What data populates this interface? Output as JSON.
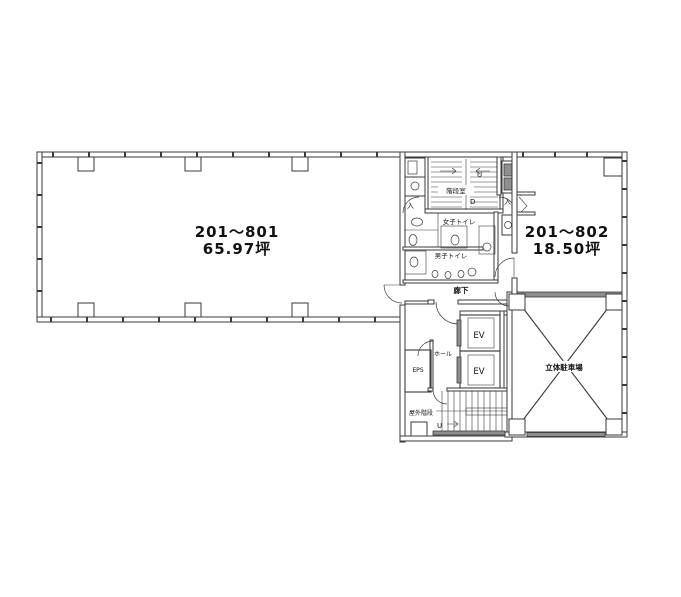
{
  "plan": {
    "colors": {
      "line": "#3a3a3a",
      "hatch": "#8f8f8f",
      "bg": "#ffffff",
      "text": "#111111"
    },
    "rooms": {
      "left": {
        "name": "201〜801",
        "area": "65.97坪"
      },
      "right": {
        "name": "201〜802",
        "area": "18.50坪"
      },
      "parking": {
        "label": "立体駐車場"
      },
      "stairwell": {
        "label": "階段室",
        "up": "U",
        "down": "D"
      },
      "womens_toilet": {
        "label": "女子トイレ"
      },
      "mens_toilet": {
        "label": "男子トイレ"
      },
      "corridor": {
        "label": "廊下"
      },
      "hall": {
        "label": "ホール"
      },
      "elevators": {
        "ev1": "EV",
        "ev2": "EV"
      },
      "eps": {
        "label": "EPS"
      },
      "outdoor_stairs": {
        "label": "屋外階段",
        "up": "U"
      },
      "entrances": {
        "left": "入",
        "right": "入"
      }
    }
  }
}
